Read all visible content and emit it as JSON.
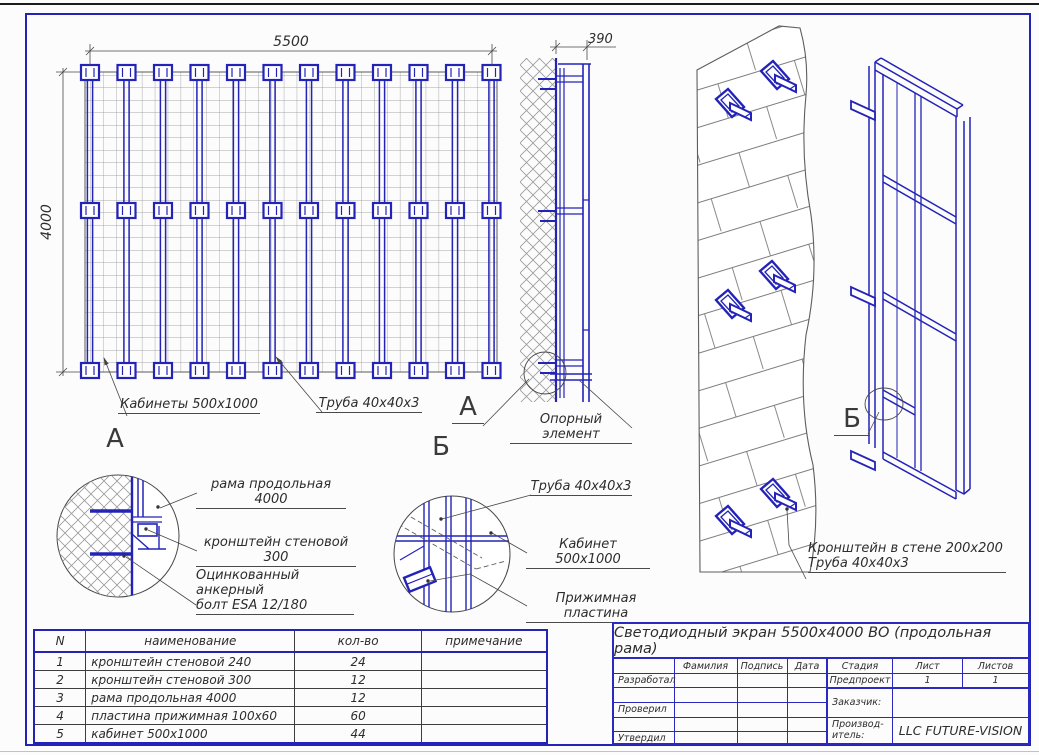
{
  "colors": {
    "blue": "#2323b8",
    "line": "#444444",
    "text": "#2d2d2d"
  },
  "front_view": {
    "dim_width": "5500",
    "dim_height": "4000",
    "label_cabinets": "Кабинеты 500x1000",
    "label_tube": "Труба 40x40x3"
  },
  "side_view": {
    "dim_depth": "390",
    "marker": "А",
    "label_support": "Опорный элемент"
  },
  "detail_a": {
    "title": "А",
    "label_frame": "рама продольная 4000",
    "label_bracket": "кронштейн стеновой 300",
    "label_bolt_1": "Оцинкованный анкерный",
    "label_bolt_2": "болт ESA 12/180"
  },
  "detail_b": {
    "title": "Б",
    "label_tube": "Труба 40x40x3",
    "label_cabinet": "Кабинет 500x1000",
    "label_plate": "Прижимная пластина"
  },
  "wall_view": {
    "marker": "Б",
    "label_line_1": "Кронштейн в стене 200x200",
    "label_line_2": "Труба 40x40x3"
  },
  "parts_table": {
    "headers": [
      "N",
      "наименование",
      "кол-во",
      "примечание"
    ],
    "rows": [
      [
        "1",
        "кронштейн стеновой 240",
        "24",
        ""
      ],
      [
        "2",
        "кронштейн стеновой 300",
        "12",
        ""
      ],
      [
        "3",
        "рама продольная 4000",
        "12",
        ""
      ],
      [
        "4",
        "пластина прижимная 100x60",
        "60",
        ""
      ],
      [
        "5",
        "кабинет 500x1000",
        "44",
        ""
      ]
    ]
  },
  "title_block": {
    "title": "Светодиодный экран 5500x4000 ВО (продольная рама)",
    "col_surname": "Фамилия",
    "col_signature": "Подпись",
    "col_date": "Дата",
    "col_stage": "Стадия",
    "col_sheet": "Лист",
    "col_sheets": "Листов",
    "row_developed": "Разработал",
    "row_checked": "Проверил",
    "row_approved": "Утвердил",
    "stage_value": "Предпроект",
    "sheet_value": "1",
    "sheets_value": "1",
    "customer_label": "Заказчик:",
    "manufacturer_label_1": "Производ-",
    "manufacturer_label_2": "итель:",
    "manufacturer_value": "LLC FUTURE-VISION"
  }
}
